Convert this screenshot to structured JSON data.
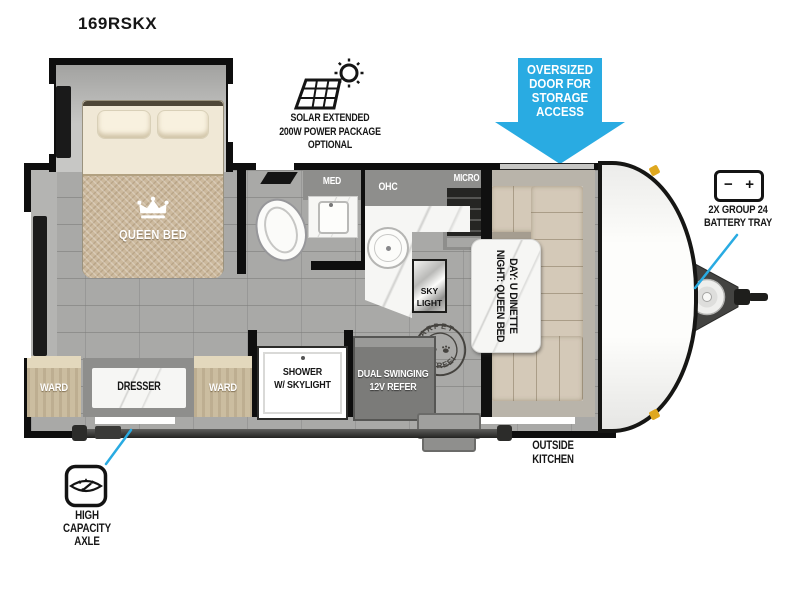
{
  "title": "169RSKX",
  "colors": {
    "accent_blue": "#29abe2",
    "marker_amber": "#dfa81f"
  },
  "icons": {
    "solar": "solar-panel-sun-icon",
    "battery": "battery-icon",
    "scale": "scale-icon",
    "crown": "crown-icon",
    "paw": "paw-print-icon",
    "propane": "propane-tank-icon"
  },
  "annotations": {
    "solar": {
      "line1": "SOLAR EXTENDED",
      "line2": "200W POWER PACKAGE",
      "line3": "OPTIONAL"
    },
    "storage_door_arrow": {
      "line1": "OVERSIZED",
      "line2": "DOOR FOR",
      "line3": "STORAGE",
      "line4": "ACCESS"
    },
    "battery": {
      "line1": "2X GROUP 24",
      "line2": "BATTERY TRAY",
      "minus": "−",
      "plus": "+"
    },
    "axle": {
      "line1": "HIGH CAPACITY",
      "line2": "AXLE"
    },
    "outside_kitchen": {
      "line1": "OUTSIDE",
      "line2": "KITCHEN"
    }
  },
  "labels": {
    "queen_bed": "QUEEN BED",
    "ward_left": "WARD",
    "ward_right": "WARD",
    "dresser": "DRESSER",
    "med": "MED",
    "ohc": "OHC",
    "micro": "MICRO",
    "skylight_line1": "SKY",
    "skylight_line2": "LIGHT",
    "shower_line1": "SHOWER",
    "shower_line2": "W/ SKYLIGHT",
    "refer_line1": "DUAL SWINGING",
    "refer_line2": "12V REFER",
    "dinette_line1": "DAY: U DINETTE",
    "dinette_line2": "NIGHT: QUEEN BED",
    "carpet_top": "CARPET",
    "carpet_bottom": "FREE!"
  }
}
